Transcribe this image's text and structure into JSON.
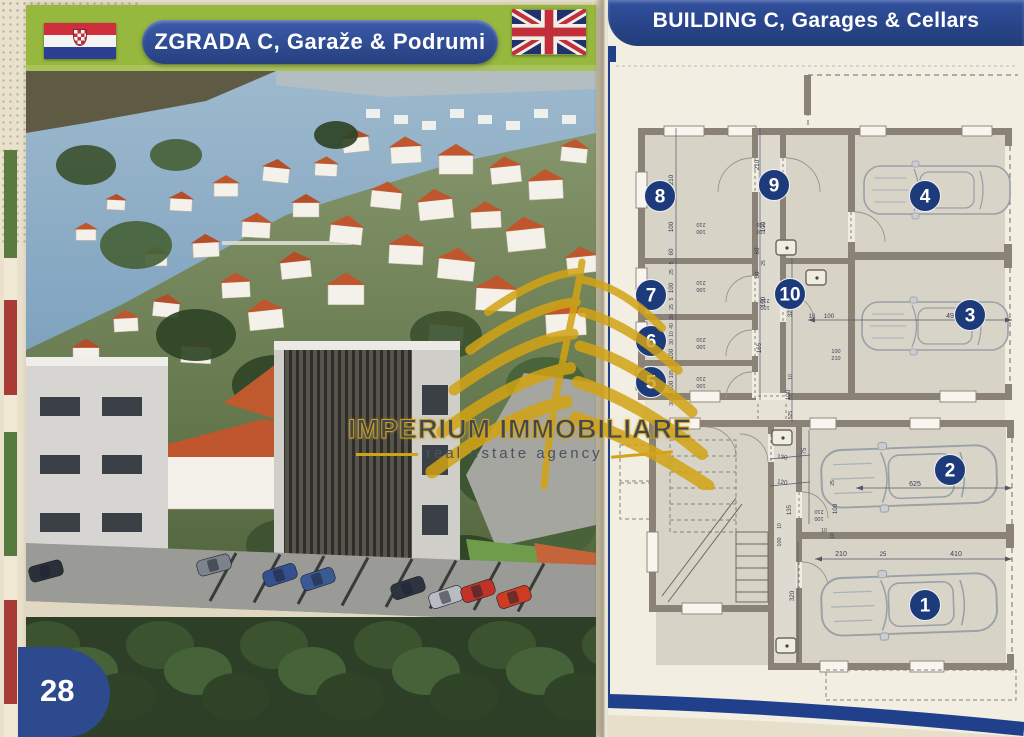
{
  "page": {
    "number": "28"
  },
  "left_header": {
    "title": "ZGRADA C, Garaže & Podrumi",
    "flag": "croatia"
  },
  "right_header": {
    "title": "BUILDING C, Garages & Cellars",
    "flag": "united-kingdom"
  },
  "watermark": {
    "brand": "IMPERIUM IMMOBILIARE",
    "tagline": "real estate agency"
  },
  "plan": {
    "colors": {
      "badge_blue": "#1d3a7a",
      "wall": "#8a8177",
      "gold": "#d2a315",
      "roof_orange": "#c0562e"
    },
    "units": [
      {
        "number": "1",
        "x": 315,
        "y": 543
      },
      {
        "number": "2",
        "x": 340,
        "y": 408
      },
      {
        "number": "3",
        "x": 360,
        "y": 253
      },
      {
        "number": "4",
        "x": 315,
        "y": 134
      },
      {
        "number": "5",
        "x": 41,
        "y": 320
      },
      {
        "number": "6",
        "x": 41,
        "y": 279
      },
      {
        "number": "7",
        "x": 41,
        "y": 233
      },
      {
        "number": "8",
        "x": 50,
        "y": 134
      },
      {
        "number": "9",
        "x": 164,
        "y": 123
      },
      {
        "number": "10",
        "x": 180,
        "y": 232
      }
    ],
    "dimensions": [
      {
        "t": "210",
        "x": 63,
        "y": 118,
        "r": -90
      },
      {
        "t": "100",
        "x": 63,
        "y": 165,
        "r": -90
      },
      {
        "t": "60",
        "x": 63,
        "y": 190,
        "r": -90
      },
      {
        "t": "5",
        "x": 63,
        "y": 201,
        "r": -90,
        "s": 5
      },
      {
        "t": "25",
        "x": 63,
        "y": 210,
        "r": -90,
        "s": 5
      },
      {
        "t": "100",
        "x": 63,
        "y": 226,
        "r": -90
      },
      {
        "t": "5",
        "x": 63,
        "y": 237,
        "r": -90,
        "s": 5
      },
      {
        "t": "25",
        "x": 63,
        "y": 245,
        "r": -90,
        "s": 5
      },
      {
        "t": "30",
        "x": 63,
        "y": 255,
        "r": -90,
        "s": 5
      },
      {
        "t": "40",
        "x": 63,
        "y": 264,
        "r": -90,
        "s": 5
      },
      {
        "t": "10",
        "x": 63,
        "y": 272,
        "r": -90,
        "s": 5
      },
      {
        "t": "30",
        "x": 63,
        "y": 280,
        "r": -90,
        "s": 5
      },
      {
        "t": "100",
        "x": 63,
        "y": 292,
        "r": -90
      },
      {
        "t": "5",
        "x": 63,
        "y": 302,
        "r": -90,
        "s": 5
      },
      {
        "t": "105",
        "x": 63,
        "y": 312,
        "r": -90,
        "s": 5
      },
      {
        "t": "100",
        "x": 63,
        "y": 324,
        "r": -90
      },
      {
        "t": "5",
        "x": 63,
        "y": 333,
        "r": -90,
        "s": 5
      },
      {
        "t": "30",
        "x": 63,
        "y": 341,
        "r": -90,
        "s": 5
      },
      {
        "t": "210",
        "x": 91,
        "y": 161,
        "r": 180,
        "s": 5.5
      },
      {
        "t": "100",
        "x": 91,
        "y": 168,
        "r": 180,
        "s": 5.5
      },
      {
        "t": "210",
        "x": 91,
        "y": 219,
        "r": 180,
        "s": 5.5
      },
      {
        "t": "100",
        "x": 91,
        "y": 226,
        "r": 180,
        "s": 5.5
      },
      {
        "t": "210",
        "x": 91,
        "y": 276,
        "r": 180,
        "s": 5.5
      },
      {
        "t": "100",
        "x": 91,
        "y": 283,
        "r": 180,
        "s": 5.5
      },
      {
        "t": "210",
        "x": 91,
        "y": 315,
        "r": 180,
        "s": 5.5
      },
      {
        "t": "100",
        "x": 91,
        "y": 322,
        "r": 180,
        "s": 5.5
      },
      {
        "t": "210",
        "x": 151,
        "y": 161,
        "r": 180,
        "s": 5.5
      },
      {
        "t": "100",
        "x": 151,
        "y": 168,
        "r": 180,
        "s": 5.5
      },
      {
        "t": "210",
        "x": 155,
        "y": 237,
        "r": 180,
        "s": 5.5
      },
      {
        "t": "100",
        "x": 155,
        "y": 244,
        "r": 180,
        "s": 5.5
      },
      {
        "t": "210",
        "x": 149,
        "y": 103,
        "r": -90
      },
      {
        "t": "100",
        "x": 155,
        "y": 165,
        "r": -90
      },
      {
        "t": "60",
        "x": 149,
        "y": 189,
        "r": -90
      },
      {
        "t": "25",
        "x": 155,
        "y": 201,
        "r": -90,
        "s": 5
      },
      {
        "t": "60",
        "x": 149,
        "y": 213,
        "r": -90
      },
      {
        "t": "100",
        "x": 155,
        "y": 240,
        "r": -90
      },
      {
        "t": "325",
        "x": 182,
        "y": 250,
        "r": -90
      },
      {
        "t": "165",
        "x": 151,
        "y": 286,
        "r": -90
      },
      {
        "t": "10",
        "x": 182,
        "y": 315,
        "r": -90,
        "s": 5
      },
      {
        "t": "100",
        "x": 180,
        "y": 333,
        "r": -90
      },
      {
        "t": "525",
        "x": 182,
        "y": 353,
        "r": -90,
        "s": 5
      },
      {
        "t": "10",
        "x": 202,
        "y": 256,
        "r": 0,
        "s": 6
      },
      {
        "t": "100",
        "x": 219,
        "y": 256,
        "r": 0
      },
      {
        "t": "495",
        "x": 342,
        "y": 256,
        "r": 0,
        "s": 7
      },
      {
        "t": "100",
        "x": 226,
        "y": 291,
        "r": 0,
        "s": 5.5
      },
      {
        "t": "210",
        "x": 226,
        "y": 298,
        "r": 0,
        "s": 5.5
      },
      {
        "t": "130",
        "x": 172,
        "y": 397,
        "r": 8
      },
      {
        "t": "75",
        "x": 196,
        "y": 389,
        "r": -90
      },
      {
        "t": "120",
        "x": 172,
        "y": 422,
        "r": 8
      },
      {
        "t": "135",
        "x": 181,
        "y": 448,
        "r": -90
      },
      {
        "t": "25",
        "x": 224,
        "y": 421,
        "r": -90,
        "s": 5
      },
      {
        "t": "100",
        "x": 227,
        "y": 447,
        "r": -90
      },
      {
        "t": "210",
        "x": 209,
        "y": 448,
        "r": 180,
        "s": 5.5
      },
      {
        "t": "100",
        "x": 209,
        "y": 455,
        "r": 180,
        "s": 5.5
      },
      {
        "t": "625",
        "x": 305,
        "y": 424,
        "r": 0,
        "s": 7
      },
      {
        "t": "10",
        "x": 214,
        "y": 470,
        "r": 0,
        "s": 5
      },
      {
        "t": "10",
        "x": 224,
        "y": 474,
        "r": -90,
        "s": 5
      },
      {
        "t": "210",
        "x": 231,
        "y": 494,
        "r": 0,
        "s": 7
      },
      {
        "t": "25",
        "x": 273,
        "y": 494,
        "r": 0,
        "s": 6
      },
      {
        "t": "410",
        "x": 346,
        "y": 494,
        "r": 0,
        "s": 7
      },
      {
        "t": "320",
        "x": 184,
        "y": 534,
        "r": -90
      },
      {
        "t": "100",
        "x": 171,
        "y": 480,
        "r": -90,
        "s": 5.5
      },
      {
        "t": "10",
        "x": 171,
        "y": 464,
        "r": -90,
        "s": 5
      }
    ]
  }
}
